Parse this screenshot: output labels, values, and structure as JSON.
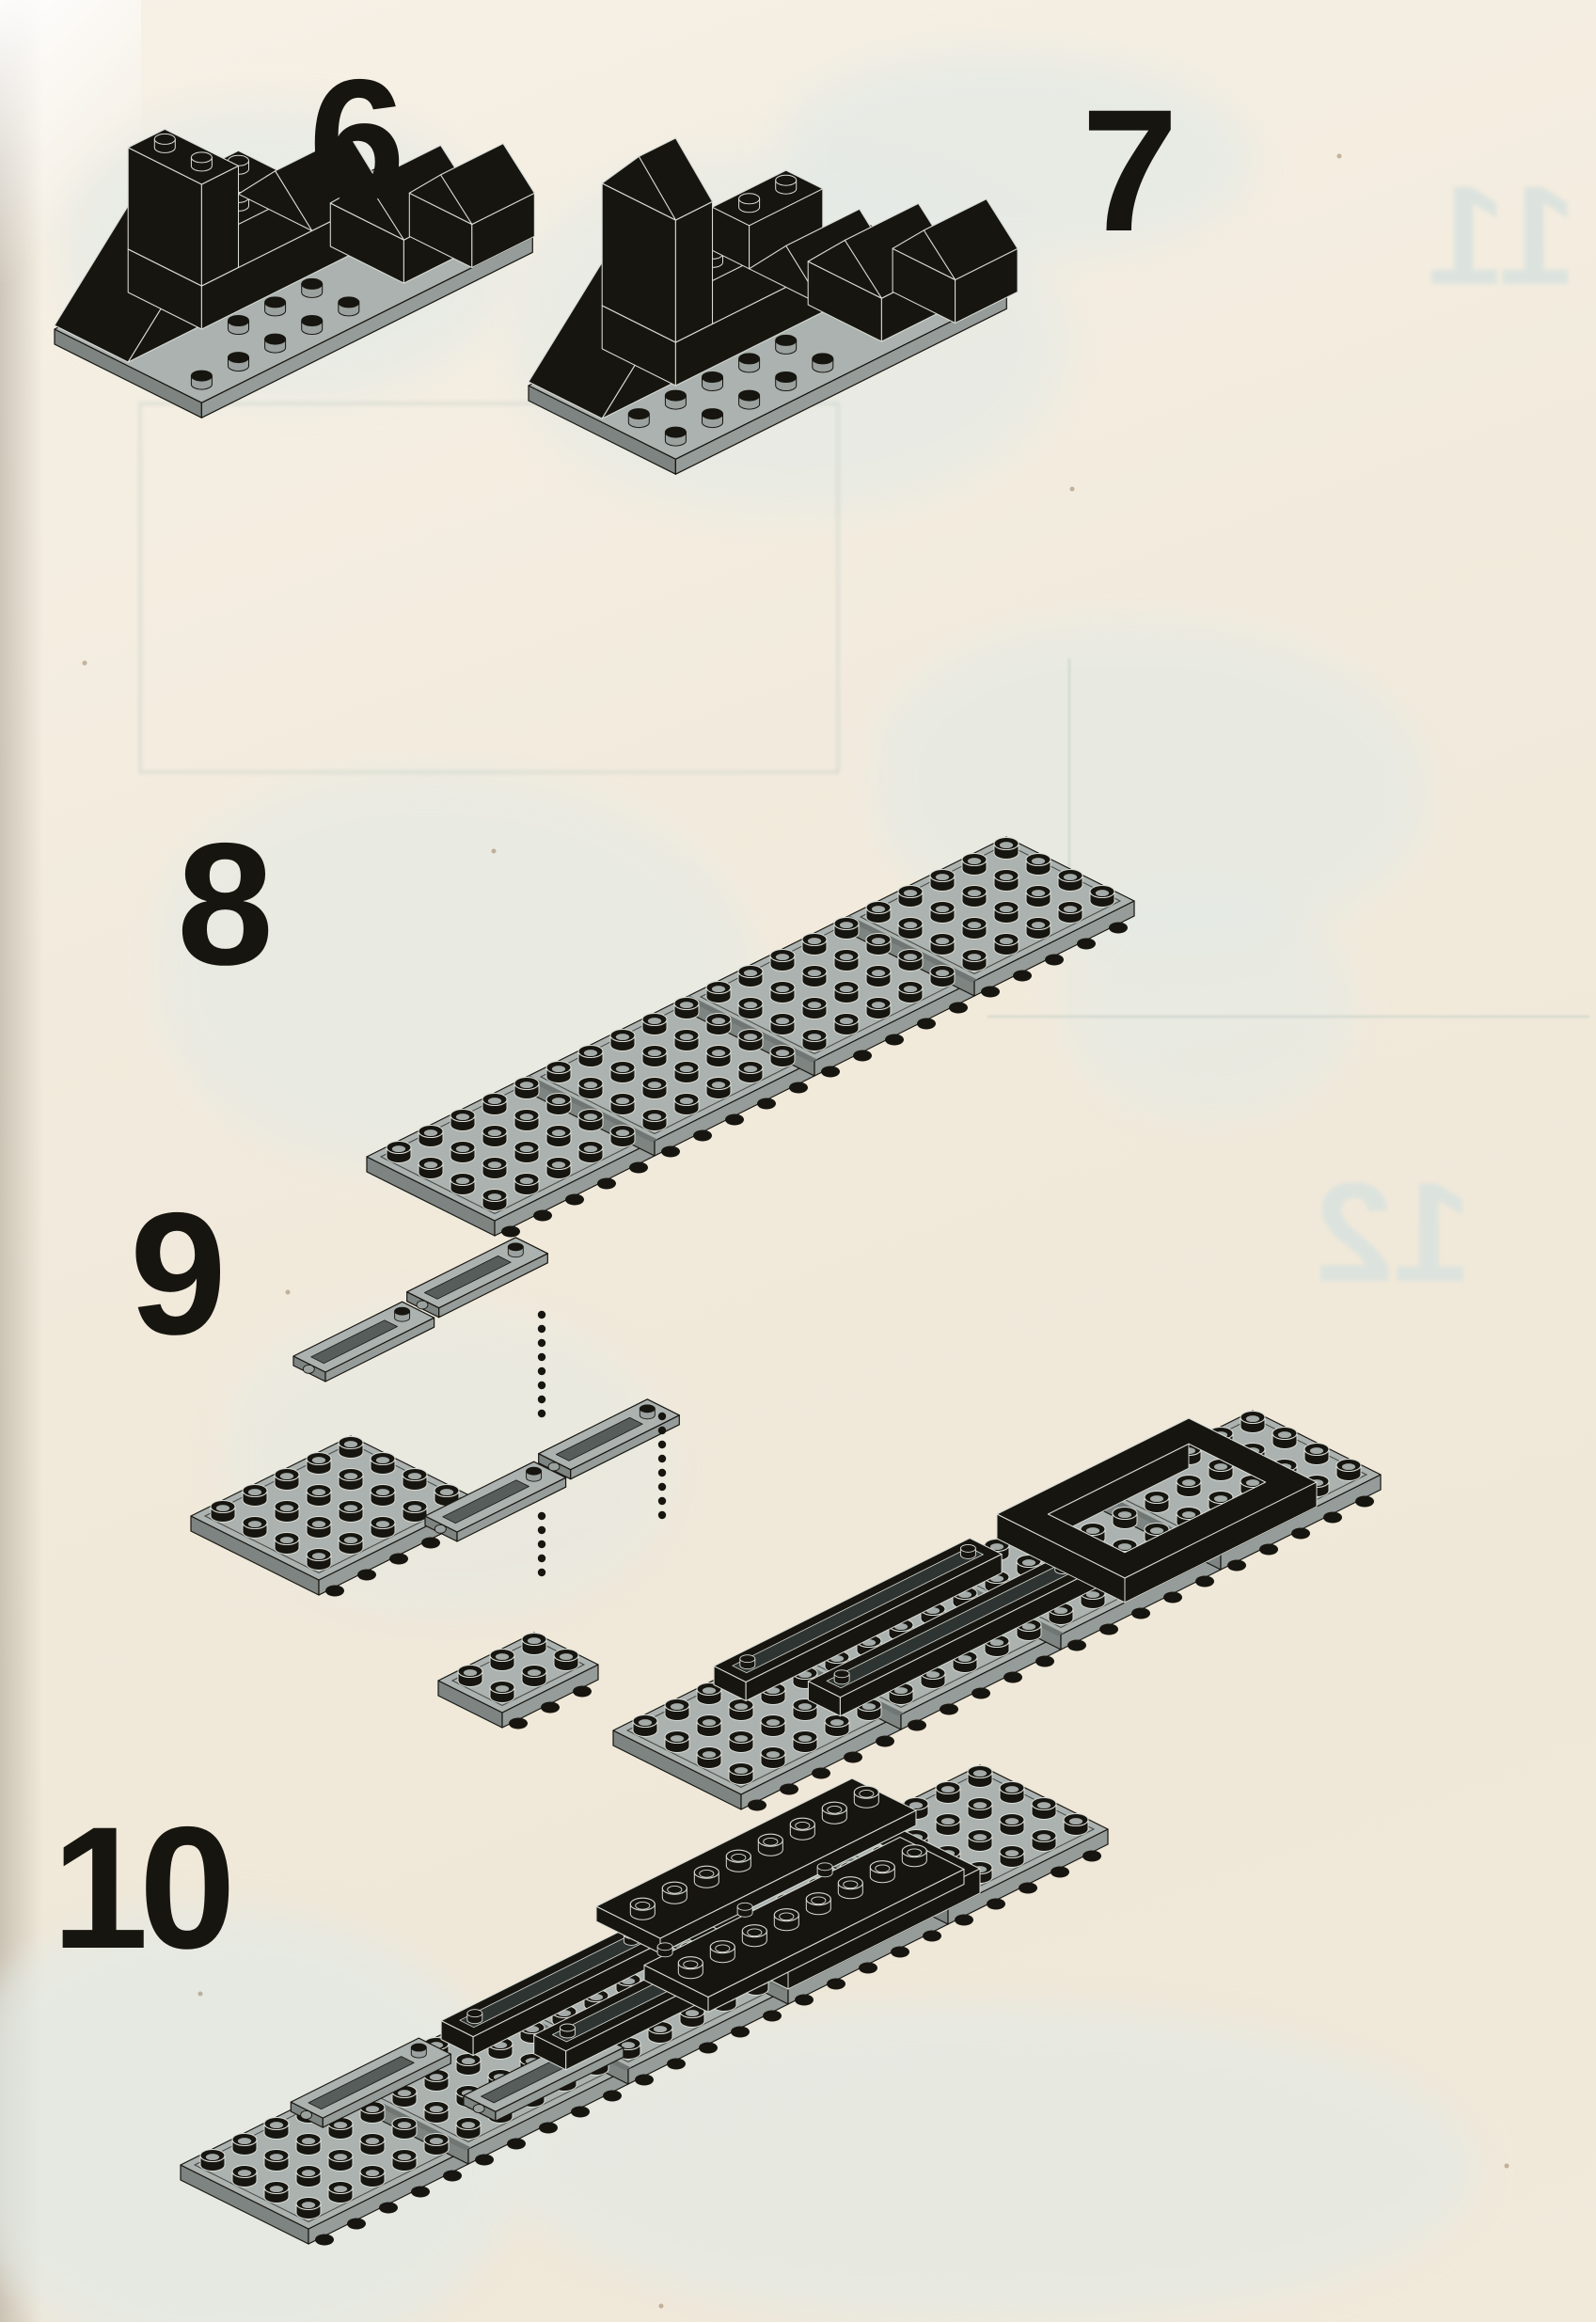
{
  "colors": {
    "paper": "#f2ecdf",
    "ink": "#17150f",
    "plate_gray": "#abb2b0",
    "edge_highlight": "#d8dcd6",
    "showthrough_blue": "#e3eae6"
  },
  "steps": [
    {
      "label": "6",
      "alt": "black hull with chimney, stepped bricks and two roof bricks on a grey baseplate"
    },
    {
      "label": "7",
      "alt": "same hull, chimney now pointed, roof bricks attached, on its grey baseplate"
    },
    {
      "label": "8",
      "alt": "four grey 4x5 plates joined into one long strip"
    },
    {
      "label": "9",
      "alt": "exploded view: two hinge plates and a 4x5 plate above the long strip fitted with black frame and wall pieces"
    },
    {
      "label": "10",
      "alt": "hinge plates folded in line; black frame and long hollow-stud plates stacked on the strip"
    }
  ],
  "ghosts": [
    {
      "label": "11"
    },
    {
      "label": "12"
    }
  ]
}
